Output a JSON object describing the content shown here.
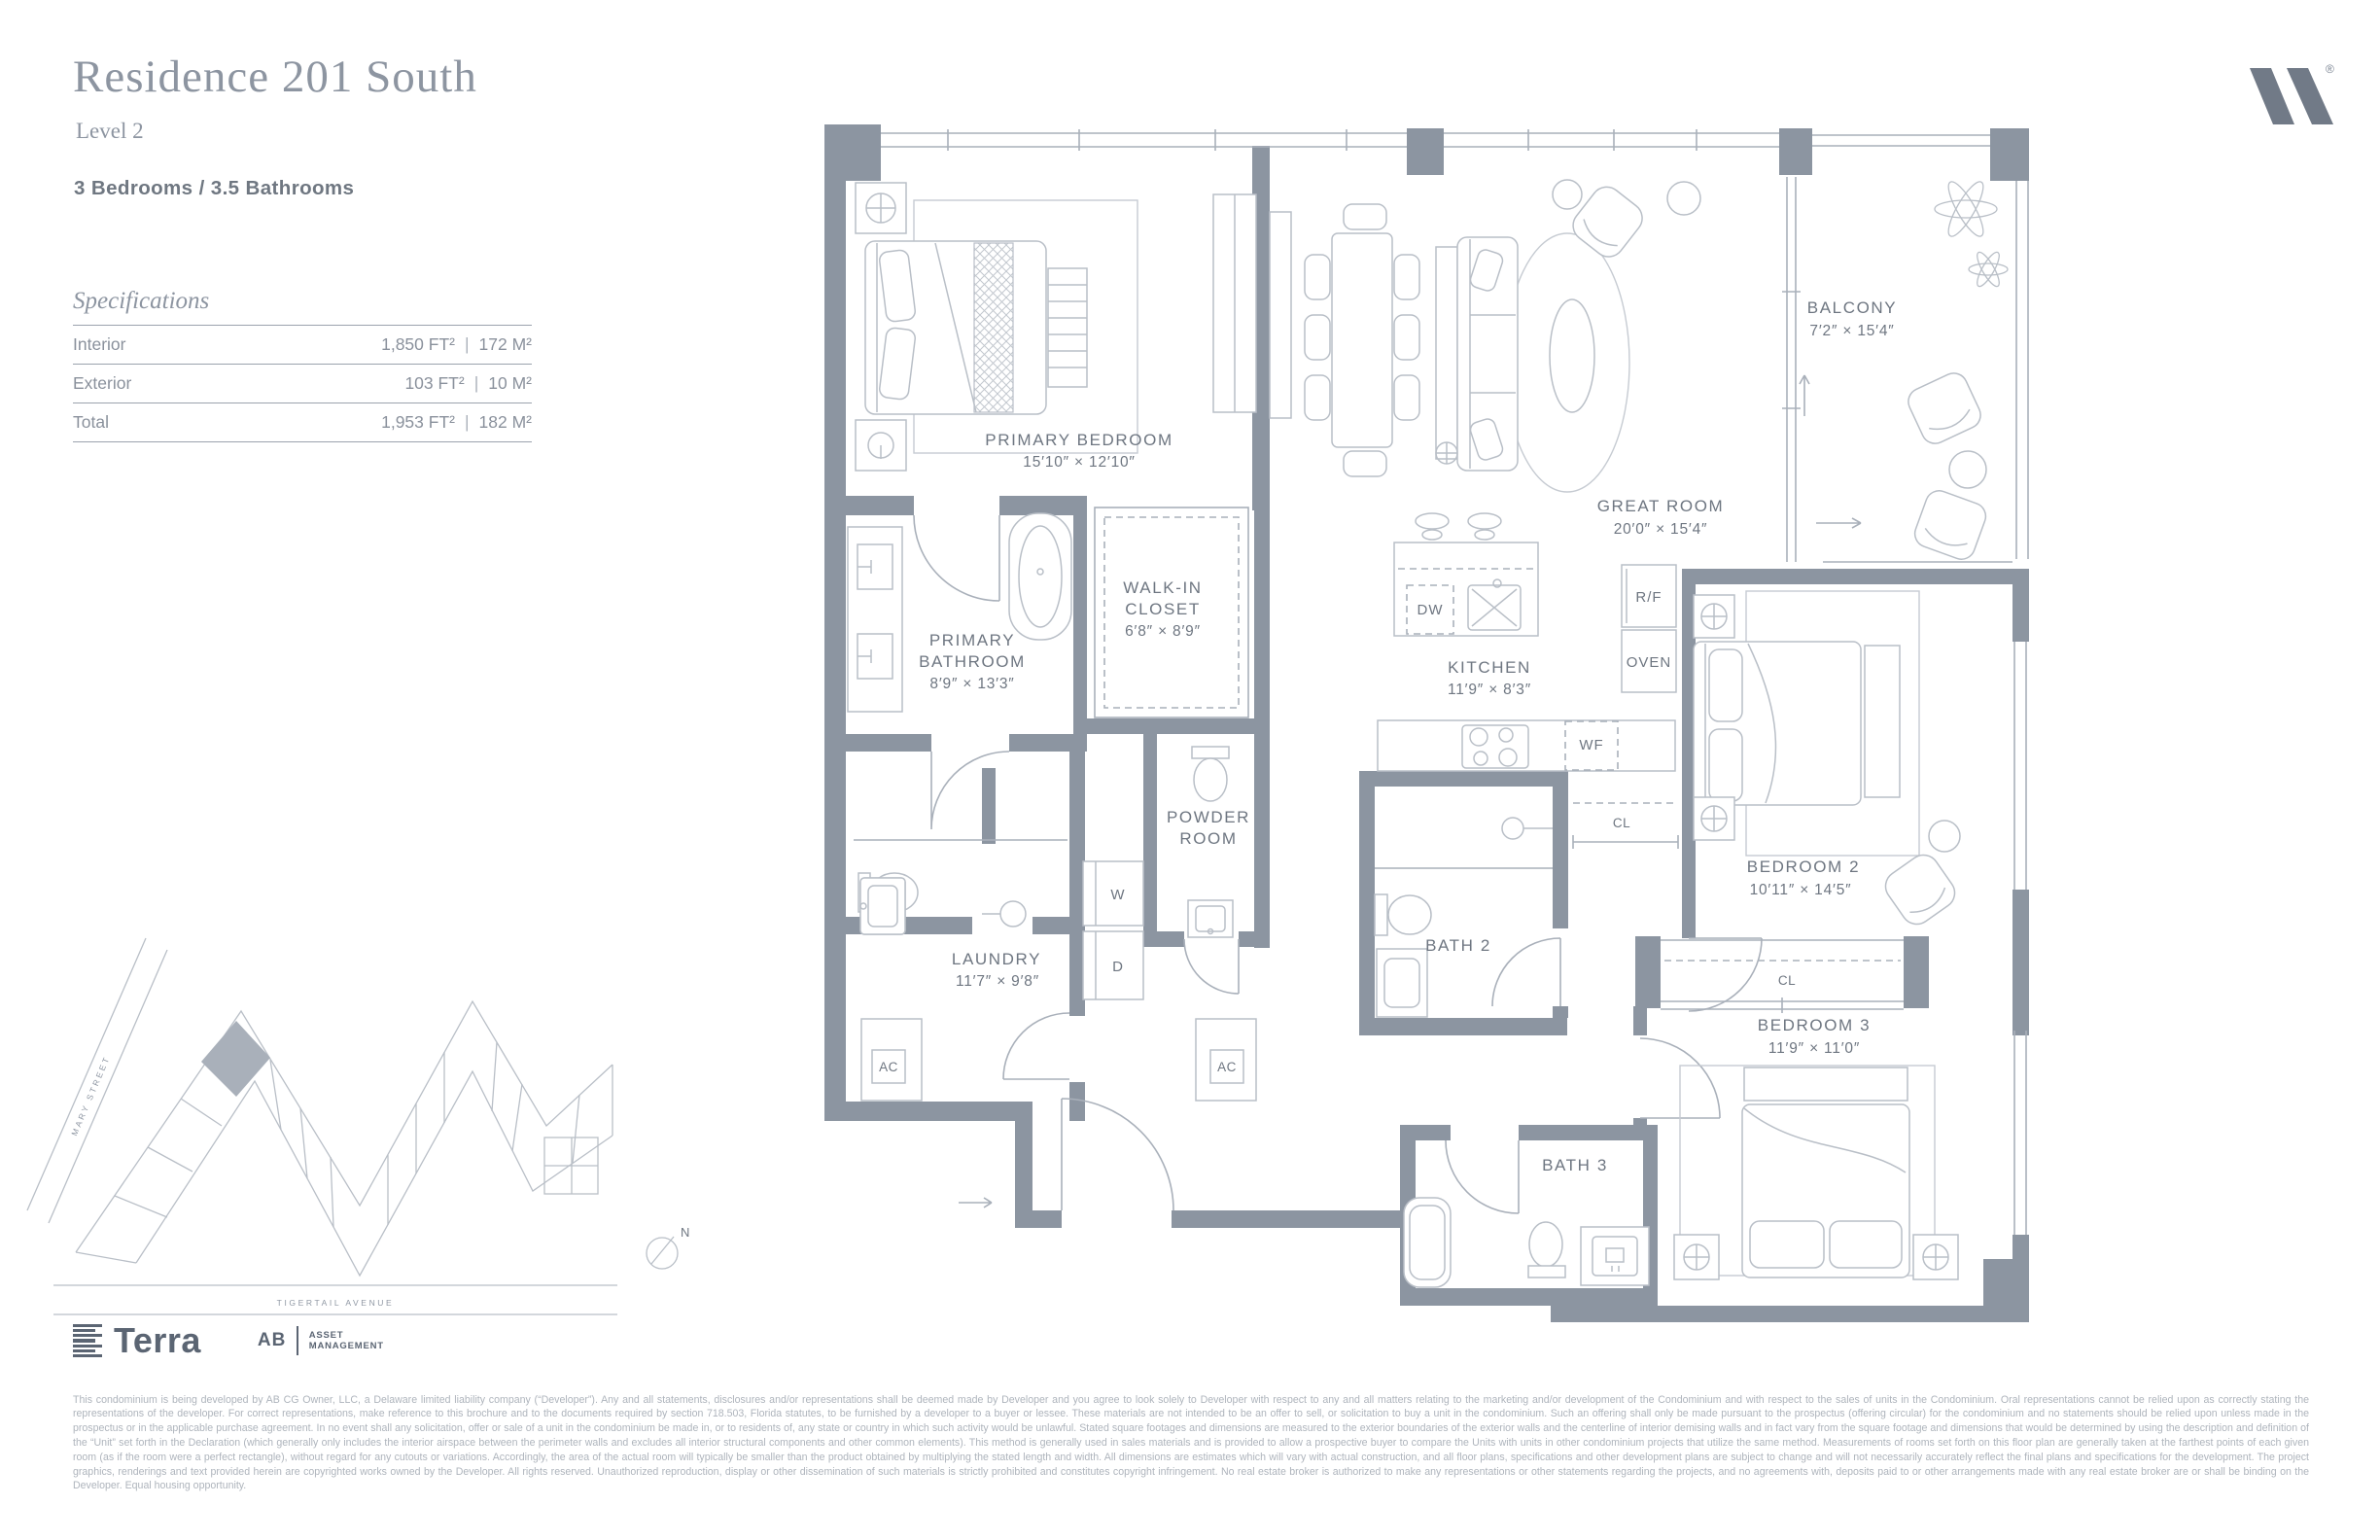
{
  "header": {
    "title": "Residence 201 South",
    "level": "Level 2",
    "config": "3 Bedrooms / 3.5 Bathrooms"
  },
  "brand": {
    "registered": "®"
  },
  "specs": {
    "heading": "Specifications",
    "divider": "|",
    "rows": [
      {
        "label": "Interior",
        "ft": "1,850 FT²",
        "m": "172 M²"
      },
      {
        "label": "Exterior",
        "ft": "103 FT²",
        "m": "10 M²"
      },
      {
        "label": "Total",
        "ft": "1,953 FT²",
        "m": "182 M²"
      }
    ]
  },
  "floorplan": {
    "rooms": {
      "primary_bedroom": {
        "name": "PRIMARY BEDROOM",
        "dims": "15′10″ × 12′10″"
      },
      "great_room": {
        "name": "GREAT ROOM",
        "dims": "20′0″ × 15′4″"
      },
      "balcony": {
        "name": "BALCONY",
        "dims": "7′2″ × 15′4″"
      },
      "primary_bathroom": {
        "line1": "PRIMARY",
        "line2": "BATHROOM",
        "dims": "8′9″ × 13′3″"
      },
      "walk_in_closet": {
        "line1": "WALK-IN",
        "line2": "CLOSET",
        "dims": "6′8″ × 8′9″"
      },
      "kitchen": {
        "name": "KITCHEN",
        "dims": "11′9″ × 8′3″"
      },
      "powder_room": {
        "line1": "POWDER",
        "line2": "ROOM"
      },
      "laundry": {
        "name": "LAUNDRY",
        "dims": "11′7″ × 9′8″"
      },
      "bath_2": {
        "name": "BATH 2"
      },
      "bedroom_2": {
        "name": "BEDROOM 2",
        "dims": "10′11″ × 14′5″"
      },
      "bedroom_3": {
        "name": "BEDROOM 3",
        "dims": "11′9″ × 11′0″"
      },
      "bath_3": {
        "name": "BATH 3"
      }
    },
    "appliances": {
      "dw": "DW",
      "rf": "R/F",
      "oven": "OVEN",
      "wf": "WF",
      "washer": "W",
      "dryer": "D",
      "ac": "AC",
      "cl": "CL"
    }
  },
  "sitemap": {
    "street_side": "MARY STREET",
    "street_bottom": "TIGERTAIL AVENUE",
    "compass": "N"
  },
  "footer": {
    "terra": "Terra",
    "ab": "AB",
    "asset_line1": "ASSET",
    "asset_line2": "MANAGEMENT",
    "legal": "This condominium is being developed by AB CG Owner, LLC, a Delaware limited liability company (“Developer”). Any and all statements, disclosures and/or representations shall be deemed made by Developer and you agree to look solely to Developer with respect to any and all matters relating to the marketing and/or development of the Condominium and with respect to the sales of units in the Condominium. Oral representations cannot be relied upon as correctly stating the representations of the developer. For correct representations, make reference to this brochure and to the documents required by section 718.503, Florida statutes, to be furnished by a developer to a buyer or lessee. These materials are not intended to be an offer to sell, or solicitation to buy a unit in the condominium. Such an offering shall only be made pursuant to the prospectus (offering circular) for the condominium and no statements should be relied upon unless made in the prospectus or in the applicable purchase agreement. In no event shall any solicitation, offer or sale of a unit in the condominium be made in, or to residents of, any state or country in which such activity would be unlawful. Stated square footages and dimensions are measured to the exterior boundaries of the exterior walls and the centerline of interior demising walls and in fact vary from the square footage and dimensions that would be determined by using the description and definition of the “Unit” set forth in the Declaration (which generally only includes the interior airspace between the perimeter walls and excludes all interior structural components and other common elements). This method is generally used in sales materials and is provided to allow a prospective buyer to compare the Units with units in other condominium projects that utilize the same method. Measurements of rooms set forth on this floor plan are generally taken at the farthest points of each given room (as if the room were a perfect rectangle), without regard for any cutouts or variations. Accordingly, the area of the actual room will typically be smaller than the product obtained by multiplying the stated length and width. All dimensions are estimates which will vary with actual construction, and all floor plans, specifications and other development plans are subject to change and will not necessarily accurately reflect the final plans and specifications for the development. The project graphics, renderings and text provided herein are copyrighted works owned by the Developer. All rights reserved. Unauthorized reproduction, display or other dissemination of such materials is strictly prohibited and constitutes copyright infringement. No real estate broker is authorized to make any representations or other statements regarding the projects, and no agreements with, deposits paid to or other arrangements made with any real estate broker are or shall be binding on the Developer. Equal housing opportunity."
  }
}
